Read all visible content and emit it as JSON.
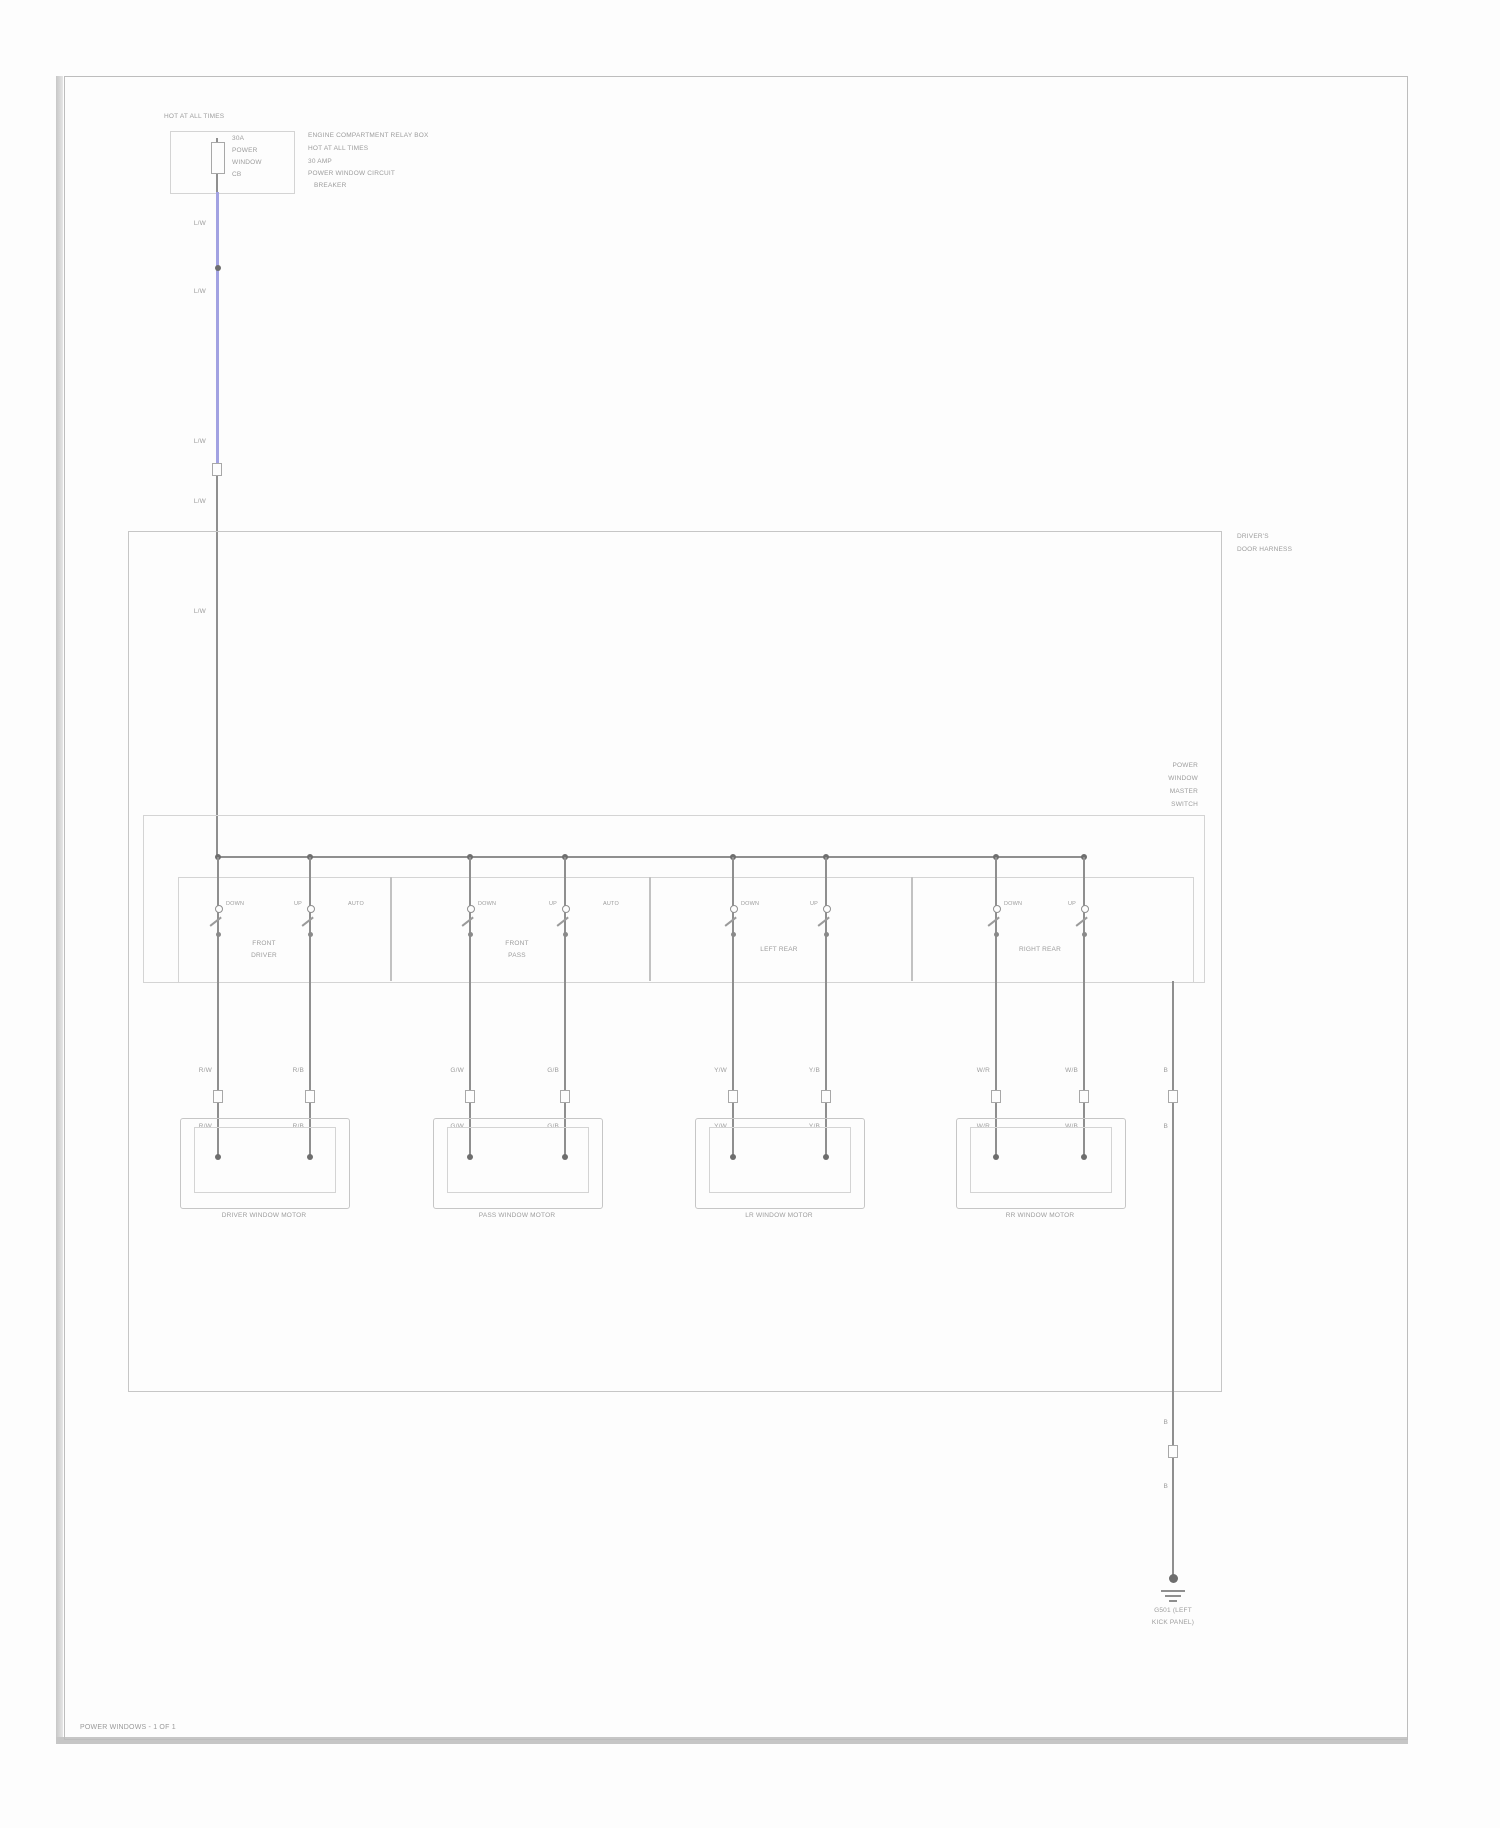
{
  "caption": "POWER WINDOWS - 1 OF 1",
  "colors": {
    "wire_blue": "#a2a2e2",
    "wire_grey": "#8f8f8f",
    "line_grey": "#c6c6c6"
  },
  "fuse_block": {
    "header": "HOT AT ALL TIMES",
    "inner_lines": [
      "30A",
      "POWER",
      "WINDOW",
      "CB"
    ],
    "note_lines": [
      "ENGINE COMPARTMENT RELAY BOX",
      "HOT AT ALL TIMES",
      "30 AMP",
      "POWER WINDOW CIRCUIT",
      "BREAKER"
    ]
  },
  "feed_wire": {
    "labels": [
      "L/W",
      "L/W",
      "L/W",
      "L/W",
      "L/W"
    ]
  },
  "door_box": {
    "label_lines": [
      "DRIVER'S",
      "DOOR HARNESS"
    ]
  },
  "master_switch": {
    "label_lines": [
      "POWER",
      "WINDOW",
      "MASTER",
      "SWITCH"
    ],
    "cells": [
      {
        "label_lines": [
          "FRONT",
          "DRIVER"
        ],
        "contact_labels": [
          "DOWN",
          "UP",
          "AUTO"
        ]
      },
      {
        "label_lines": [
          "FRONT",
          "PASS"
        ],
        "contact_labels": [
          "DOWN",
          "UP",
          "AUTO"
        ]
      },
      {
        "label_lines": [
          "LEFT REAR",
          ""
        ],
        "contact_labels": [
          "DOWN",
          "UP",
          ""
        ]
      },
      {
        "label_lines": [
          "RIGHT REAR",
          ""
        ],
        "contact_labels": [
          "DOWN",
          "UP",
          ""
        ]
      }
    ]
  },
  "motors": [
    {
      "label": "DRIVER WINDOW MOTOR",
      "wire_codes": [
        "R/W",
        "R/B"
      ]
    },
    {
      "label": "PASS WINDOW MOTOR",
      "wire_codes": [
        "G/W",
        "G/B"
      ]
    },
    {
      "label": "LR WINDOW MOTOR",
      "wire_codes": [
        "Y/W",
        "Y/B"
      ]
    },
    {
      "label": "RR WINDOW MOTOR",
      "wire_codes": [
        "W/R",
        "W/B"
      ]
    }
  ],
  "ground": {
    "codes": [
      "B",
      "B",
      "B",
      "B"
    ],
    "id_lines": [
      "G501 (LEFT",
      "KICK PANEL)"
    ]
  }
}
